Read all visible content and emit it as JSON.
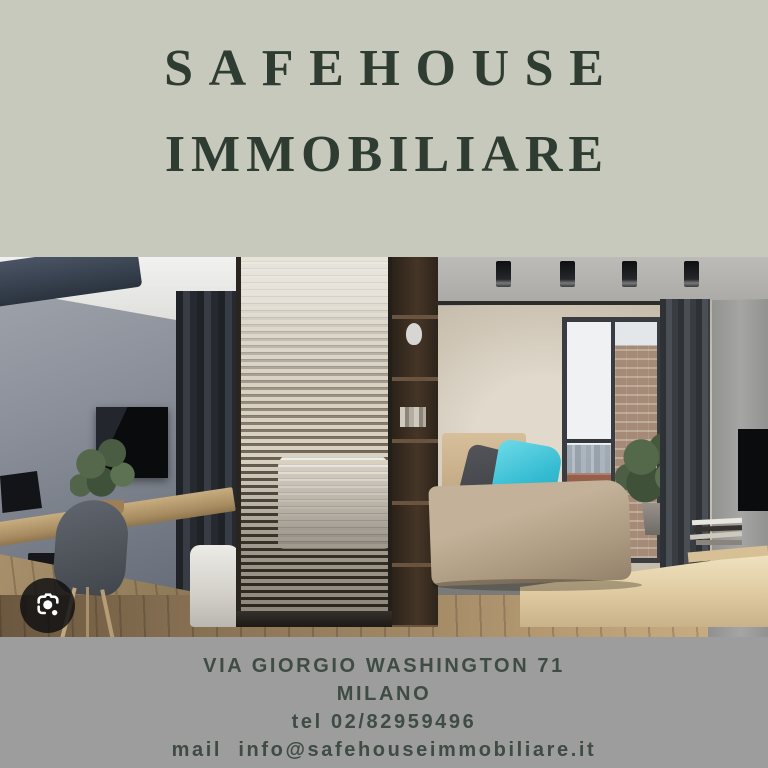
{
  "brand": {
    "line1": "SAFEHOUSE",
    "line2": "IMMOBILIARE"
  },
  "contact": {
    "address": "VIA GIORGIO WASHINGTON 71",
    "city": "MILANO",
    "phone": "tel 02/82959496",
    "email": "mail  info@safehouseimmobiliare.it"
  },
  "photo": {
    "description": "Modern studio apartment interior: gray bedroom wall with TV, wooden desk and chair, wooden slat room divider with bed behind, beige daybed with dark gray and cyan pillows, balcony glass door with city view and brick wall, dark curtains, concrete ceiling with black spotlights",
    "overlay_icon": "google-lens-camera"
  },
  "colors": {
    "top_background": "#c8c9bd",
    "bottom_background": "#9d9d9d",
    "title_text": "#2e3c32",
    "contact_text": "#3e4c44",
    "accent_pillow_cyan": "#35bcd2",
    "lens_badge_background": "#101012"
  }
}
